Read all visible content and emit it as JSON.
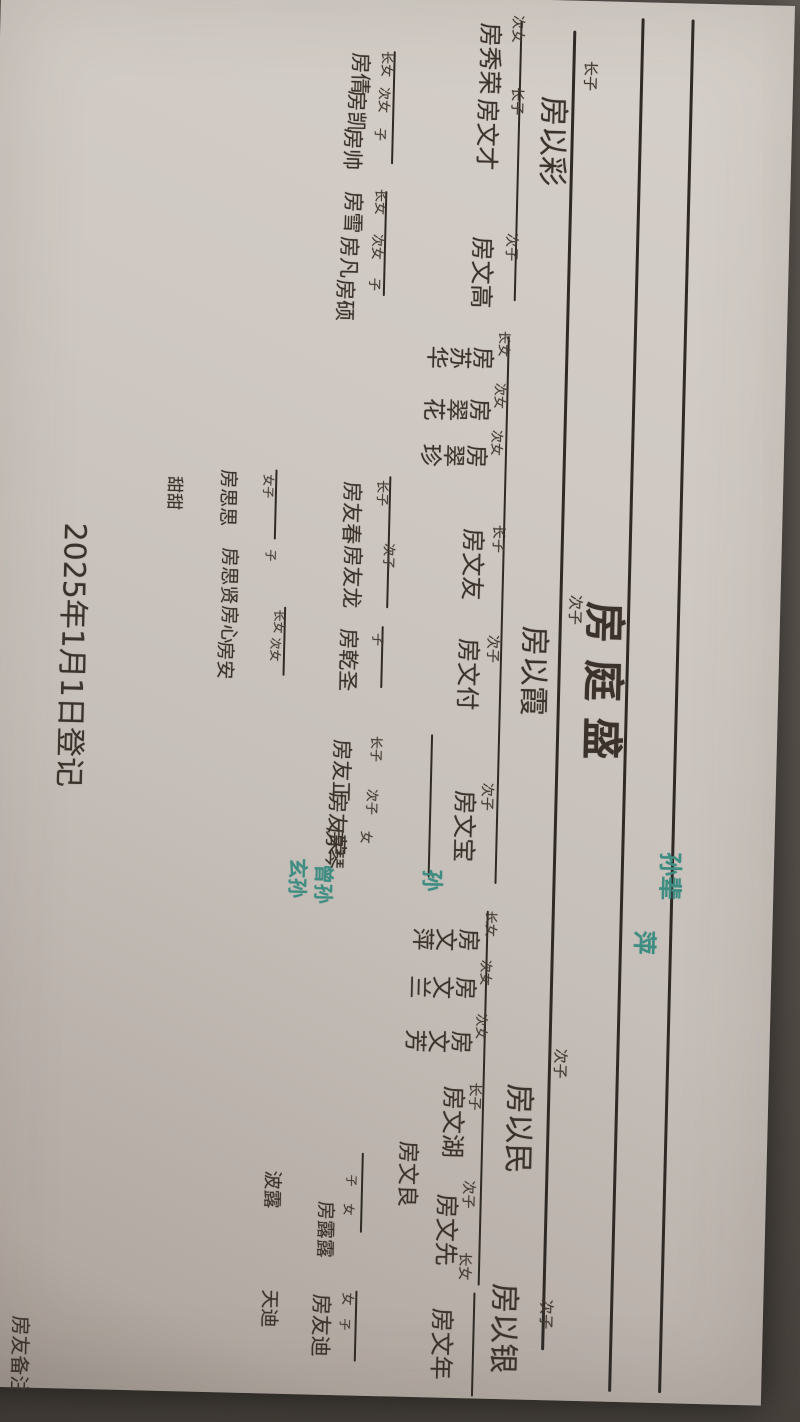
{
  "meta": {
    "document_kind": "handwritten family tree on paper, photographed rotated 90°",
    "ink_color": "#3a322b",
    "teal_color": "#3f8d82",
    "paper_color": "#cfc8c2",
    "background_color": "#5a544e"
  },
  "title": {
    "text": "房庭盛",
    "x": 600,
    "y": 154,
    "size": 42
  },
  "registration_date": {
    "text": "2025年1月1日登记",
    "x": 534,
    "y": 692,
    "size": 30
  },
  "corner_note": {
    "text": "房友备注",
    "x": 1328,
    "y": 732,
    "size": 20
  },
  "teal_annotations": [
    {
      "text": "孙辈",
      "x": 849,
      "y": 92,
      "size": 24
    },
    {
      "text": "萍",
      "x": 928,
      "y": 116,
      "size": 24
    },
    {
      "text": "孙",
      "x": 872,
      "y": 332,
      "size": 22
    },
    {
      "text": "曾孙",
      "x": 869,
      "y": 440,
      "size": 20
    },
    {
      "text": "玄孙",
      "x": 864,
      "y": 466,
      "size": 20
    }
  ],
  "lines": [
    {
      "x1": 16,
      "y": 100,
      "x2": 1390,
      "w": 3
    },
    {
      "x1": 16,
      "y": 150,
      "x2": 1390,
      "w": 3
    },
    {
      "x1": 30,
      "y": 218,
      "x2": 1350,
      "w": 3
    },
    {
      "x1": 22,
      "y": 272,
      "x2": 302,
      "w": 2
    },
    {
      "x1": 337,
      "y": 277,
      "x2": 885,
      "w": 2
    },
    {
      "x1": 912,
      "y": 284,
      "x2": 1287,
      "w": 2
    },
    {
      "x1": 1294,
      "y": 288,
      "x2": 1398,
      "w": 2
    },
    {
      "x1": 55,
      "y": 398,
      "x2": 168,
      "w": 2
    },
    {
      "x1": 195,
      "y": 403,
      "x2": 300,
      "w": 2
    },
    {
      "x1": 480,
      "y": 392,
      "x2": 612,
      "w": 2
    },
    {
      "x1": 630,
      "y": 396,
      "x2": 692,
      "w": 2
    },
    {
      "x1": 737,
      "y": 344,
      "x2": 880,
      "w": 2
    },
    {
      "x1": 1157,
      "y": 403,
      "x2": 1237,
      "w": 2
    },
    {
      "x1": 1295,
      "y": 406,
      "x2": 1366,
      "w": 2
    },
    {
      "x1": 476,
      "y": 506,
      "x2": 546,
      "w": 2
    },
    {
      "x1": 613,
      "y": 494,
      "x2": 682,
      "w": 2
    }
  ],
  "family": {
    "name": "房庭盛",
    "children": [
      {
        "label": "长子",
        "name": "房以彩",
        "x": 96,
        "y": 224,
        "lx": 60,
        "ly": 196,
        "size": 30,
        "lsize": 15,
        "children": [
          {
            "label": "次女",
            "name": "房秀荣",
            "x": 24,
            "y": 292,
            "lx": 16,
            "ly": 270,
            "size": 24,
            "lsize": 14
          },
          {
            "label": "长子",
            "name": "房文才",
            "x": 100,
            "y": 293,
            "lx": 88,
            "ly": 269,
            "size": 24,
            "lsize": 14,
            "children": [
              {
                "label": "长女",
                "name": "房倩",
                "x": 57,
                "y": 423,
                "lx": 55,
                "ly": 401,
                "size": 21,
                "lsize": 13
              },
              {
                "label": "次女",
                "name": "房凯",
                "x": 95,
                "y": 426,
                "lx": 91,
                "ly": 403,
                "size": 21,
                "lsize": 13
              },
              {
                "label": "子",
                "name": "房帅",
                "x": 133,
                "y": 429,
                "lx": 132,
                "ly": 406,
                "size": 21,
                "lsize": 13
              }
            ]
          },
          {
            "label": "次子",
            "name": "房文高",
            "x": 238,
            "y": 295,
            "lx": 234,
            "ly": 271,
            "size": 24,
            "lsize": 14,
            "children": [
              {
                "label": "长女",
                "name": "房雪",
                "x": 196,
                "y": 427,
                "lx": 193,
                "ly": 404,
                "size": 21,
                "lsize": 13
              },
              {
                "label": "次女",
                "name": "房凡",
                "x": 241,
                "y": 430,
                "lx": 238,
                "ly": 406,
                "size": 21,
                "lsize": 13
              },
              {
                "label": "子",
                "name": "房硕",
                "x": 284,
                "y": 433,
                "lx": 282,
                "ly": 408,
                "size": 21,
                "lsize": 13
              }
            ]
          }
        ]
      },
      {
        "label": "次子",
        "name": "房以霞",
        "x": 626,
        "y": 230,
        "lx": 594,
        "ly": 198,
        "size": 30,
        "lsize": 15,
        "children": [
          {
            "label": "长女",
            "name": "房苏华",
            "x": 344,
            "y": 291,
            "lx": 332,
            "ly": 277,
            "size": 23,
            "lsize": 13,
            "vertical": true
          },
          {
            "label": "次女",
            "name": "房翠花",
            "x": 396,
            "y": 293,
            "lx": 384,
            "ly": 280,
            "size": 23,
            "lsize": 13,
            "vertical": true
          },
          {
            "label": "次女",
            "name": "房翠珍",
            "x": 442,
            "y": 295,
            "lx": 431,
            "ly": 282,
            "size": 23,
            "lsize": 13,
            "vertical": true
          },
          {
            "label": "长子",
            "name": "房文友",
            "x": 530,
            "y": 297,
            "lx": 526,
            "ly": 277,
            "size": 24,
            "lsize": 14,
            "children": [
              {
                "label": "长子",
                "name": "房友春",
                "x": 486,
                "y": 421,
                "lx": 484,
                "ly": 395,
                "size": 21,
                "lsize": 13,
                "children": [
                  {
                    "label": "女子",
                    "name": "房思思",
                    "x": 477,
                    "y": 546,
                    "lx": 481,
                    "ly": 509,
                    "size": 19,
                    "lsize": 12
                  },
                  {
                    "label": "",
                    "name": "甜甜",
                    "x": 485,
                    "y": 601,
                    "lx": 0,
                    "ly": 0,
                    "size": 17,
                    "lsize": 12
                  }
                ]
              },
              {
                "label": "次子",
                "name": "房友龙",
                "x": 550,
                "y": 419,
                "lx": 547,
                "ly": 387,
                "size": 21,
                "lsize": 13,
                "children": [
                  {
                    "label": "子",
                    "name": "房思贤",
                    "x": 555,
                    "y": 543,
                    "lx": 556,
                    "ly": 505,
                    "size": 19,
                    "lsize": 12
                  }
                ]
              }
            ]
          },
          {
            "label": "次子",
            "name": "房文付",
            "x": 640,
            "y": 299,
            "lx": 636,
            "ly": 280,
            "size": 24,
            "lsize": 14,
            "children": [
              {
                "label": "子",
                "name": "房乾圣",
                "x": 633,
                "y": 421,
                "lx": 637,
                "ly": 396,
                "size": 21,
                "lsize": 13,
                "children": [
                  {
                    "label": "长女",
                    "name": "房心",
                    "x": 613,
                    "y": 542,
                    "lx": 616,
                    "ly": 495,
                    "size": 19,
                    "lsize": 12
                  },
                  {
                    "label": "次女",
                    "name": "房安",
                    "x": 649,
                    "y": 545,
                    "lx": 644,
                    "ly": 498,
                    "size": 19,
                    "lsize": 12
                  }
                ]
              }
            ]
          },
          {
            "label": "次子",
            "name": "房文宝",
            "x": 792,
            "y": 299,
            "lx": 784,
            "ly": 282,
            "size": 24,
            "lsize": 14,
            "children": [
              {
                "label": "长子",
                "name": "房友正",
                "x": 744,
                "y": 425,
                "lx": 740,
                "ly": 395,
                "size": 21,
                "lsize": 13
              },
              {
                "label": "次子",
                "name": "房友荣",
                "x": 797,
                "y": 428,
                "lx": 793,
                "ly": 398,
                "size": 21,
                "lsize": 13
              },
              {
                "label": "女",
                "name": "房琴",
                "x": 832,
                "y": 430,
                "lx": 835,
                "ly": 403,
                "size": 21,
                "lsize": 13
              }
            ]
          }
        ]
      },
      {
        "label": "次子",
        "name": "房以民",
        "x": 1084,
        "y": 234,
        "lx": 1048,
        "ly": 202,
        "size": 30,
        "lsize": 15,
        "children": [
          {
            "label": "长女",
            "name": "房文萍",
            "x": 926,
            "y": 291,
            "lx": 912,
            "ly": 276,
            "size": 23,
            "lsize": 13,
            "vertical": true
          },
          {
            "label": "次女",
            "name": "房文兰",
            "x": 974,
            "y": 293,
            "lx": 961,
            "ly": 280,
            "size": 23,
            "lsize": 13,
            "vertical": true
          },
          {
            "label": "次女",
            "name": "房文芳",
            "x": 1028,
            "y": 296,
            "lx": 1015,
            "ly": 283,
            "size": 23,
            "lsize": 13,
            "vertical": true
          },
          {
            "label": "长子",
            "name": "房文湖",
            "x": 1088,
            "y": 303,
            "lx": 1084,
            "ly": 287,
            "size": 24,
            "lsize": 14,
            "children": [
              {
                "label": "",
                "name": "房文良",
                "x": 1144,
                "y": 349,
                "lx": 0,
                "ly": 0,
                "size": 22,
                "lsize": 13,
                "children": [
                  {
                    "label": "子",
                    "name": "房露露",
                    "x": 1206,
                    "y": 431,
                    "lx": 1179,
                    "ly": 409,
                    "size": 19,
                    "lsize": 12
                  },
                  {
                    "label": "女",
                    "name": "波露",
                    "x": 1177,
                    "y": 485,
                    "lx": 1208,
                    "ly": 411,
                    "size": 19,
                    "lsize": 12
                  }
                ]
              }
            ]
          },
          {
            "label": "次子",
            "name": "房文先",
            "x": 1196,
            "y": 307,
            "lx": 1182,
            "ly": 291,
            "size": 24,
            "lsize": 14
          }
        ]
      },
      {
        "label": "次子",
        "name": "房以银",
        "x": 1284,
        "y": 244,
        "lx": 1299,
        "ly": 210,
        "size": 30,
        "lsize": 15,
        "children": [
          {
            "label": "长女",
            "name": "房文年",
            "x": 1310,
            "y": 309,
            "lx": 1254,
            "ly": 293,
            "size": 24,
            "lsize": 14
          },
          {
            "label": "女",
            "name": "房友迪",
            "x": 1299,
            "y": 432,
            "lx": 1297,
            "ly": 410,
            "size": 21,
            "lsize": 13
          },
          {
            "label": "子",
            "name": "天迪",
            "x": 1296,
            "y": 485,
            "lx": 1323,
            "ly": 412,
            "size": 19,
            "lsize": 12
          }
        ]
      }
    ]
  }
}
